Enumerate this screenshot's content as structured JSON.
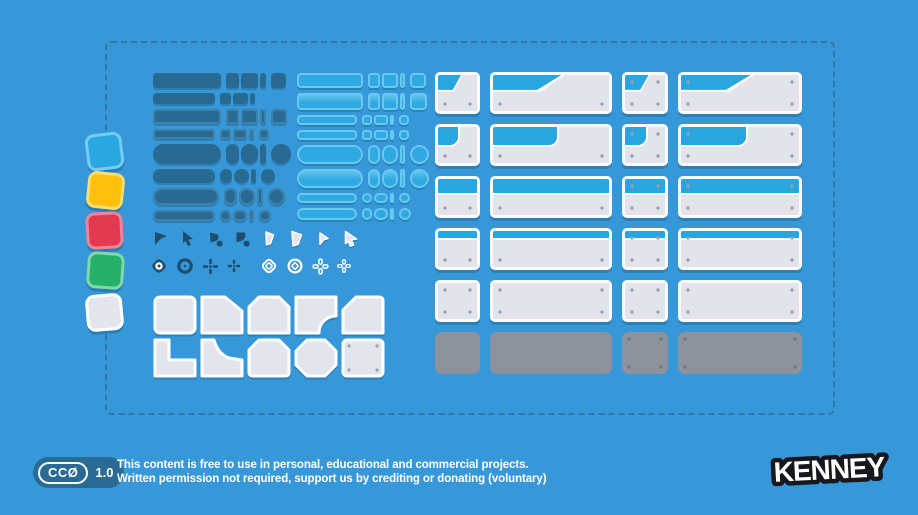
{
  "palette": {
    "bg": "#3798d9",
    "dash": "#2b79a8",
    "navy": "#1d4e6e",
    "badge_bg": "#2a6b94",
    "dark_btn": "#296a92",
    "dark_btn_edge": "#3e81ab",
    "light_btn": "#2ea9e1",
    "light_btn_border": "#69c8f0",
    "panel_body": "#e2e3eb",
    "panel_header": "#29a5df",
    "panel_border": "#fafafa",
    "panel_grey": "#8d929c",
    "screw": "#9aa0ad",
    "screw_dark": "#73777f",
    "key_fill": "#e3e5ec",
    "cursor_fill": "#e1e4ec",
    "sq_blue": "#2aa6e0",
    "sq_blue_b": "#74ccf2",
    "sq_yellow": "#fec00d",
    "sq_yellow_b": "#ffdc72",
    "sq_red": "#e23a51",
    "sq_red_b": "#ef8497",
    "sq_green": "#25b169",
    "sq_green_b": "#7fd8a8",
    "sq_white": "#e4e6ed",
    "sq_white_b": "#ffffff"
  },
  "license": {
    "badge_label": "CCØ",
    "version": "1.0",
    "line1": "This content is free to use in personal, educational and commercial projects.",
    "line2": "Written permission not required, support us by crediting or donating (voluntary)"
  },
  "brand": {
    "logo_text": "KENNEY"
  }
}
